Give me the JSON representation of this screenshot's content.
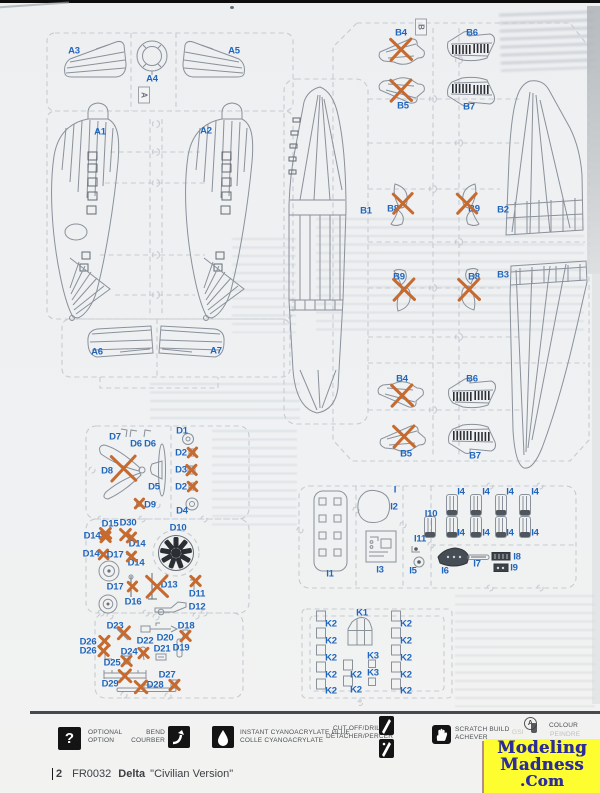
{
  "colors": {
    "label_blue": "#2166bd",
    "cross_orange": "#c66a2f",
    "watermark_bg": "#fdfd2f",
    "watermark_text": "#2d2d99",
    "paper": "#eff1f2"
  },
  "footer": {
    "page_number": "2",
    "kit_code": "FR0032",
    "kit_name": "Delta",
    "kit_variant": "\"Civilian Version\""
  },
  "watermark": {
    "line1": "Modeling",
    "line2": "Madness",
    "line3": ".Com"
  },
  "legend": {
    "optional": {
      "line1": "OPTIONAL",
      "line2": "OPTION"
    },
    "bend": {
      "line1": "BEND",
      "line2": "COURBER"
    },
    "glue": {
      "line1": "INSTANT CYANOACRYLATE GLUE",
      "line2": "COLLE CYANOACRYLATE"
    },
    "cut": {
      "line1": "CUT OFF/DRILL",
      "line2": "DÉTACHER/PERCER"
    },
    "scratch": {
      "line1": "SCRATCH BUILD",
      "line2": "ACHEVER"
    },
    "colour": {
      "badge": "A",
      "line1": "COLOUR",
      "line2": "PEINDRE",
      "note": "GSI"
    }
  },
  "sprues": [
    {
      "id": "A",
      "tag": {
        "text": "A",
        "x": 144,
        "y": 95
      },
      "parts": [
        {
          "label": "A3",
          "x": 74,
          "y": 51
        },
        {
          "label": "A4",
          "x": 152,
          "y": 79
        },
        {
          "label": "A5",
          "x": 234,
          "y": 51
        },
        {
          "label": "A1",
          "x": 100,
          "y": 132
        },
        {
          "label": "A2",
          "x": 206,
          "y": 131
        },
        {
          "label": "A6",
          "x": 97,
          "y": 352
        },
        {
          "label": "A7",
          "x": 216,
          "y": 351
        }
      ]
    },
    {
      "id": "B",
      "tag": {
        "text": "B",
        "x": 421,
        "y": 27
      },
      "parts": [
        {
          "label": "B4",
          "x": 401,
          "y": 33,
          "cross": {
            "x": 401,
            "y": 50,
            "s": 26
          }
        },
        {
          "label": "B6",
          "x": 472,
          "y": 33
        },
        {
          "label": "B5",
          "x": 403,
          "y": 106,
          "cross": {
            "x": 401,
            "y": 91,
            "s": 26
          }
        },
        {
          "label": "B7",
          "x": 469,
          "y": 107
        },
        {
          "label": "B1",
          "x": 366,
          "y": 211
        },
        {
          "label": "B8",
          "x": 393,
          "y": 209,
          "cross": {
            "x": 403,
            "y": 204,
            "s": 24
          }
        },
        {
          "label": "B9",
          "x": 474,
          "y": 209,
          "cross": {
            "x": 467,
            "y": 204,
            "s": 24
          }
        },
        {
          "label": "B2",
          "x": 503,
          "y": 210
        },
        {
          "label": "B9",
          "x": 399,
          "y": 277,
          "cross": {
            "x": 404,
            "y": 290,
            "s": 26
          }
        },
        {
          "label": "B8",
          "x": 474,
          "y": 277,
          "cross": {
            "x": 469,
            "y": 290,
            "s": 26
          }
        },
        {
          "label": "B3",
          "x": 503,
          "y": 275
        },
        {
          "label": "B4",
          "x": 402,
          "y": 379,
          "cross": {
            "x": 402,
            "y": 396,
            "s": 26
          }
        },
        {
          "label": "B6",
          "x": 472,
          "y": 379
        },
        {
          "label": "B5",
          "x": 406,
          "y": 454,
          "cross": {
            "x": 404,
            "y": 437,
            "s": 26
          }
        },
        {
          "label": "B7",
          "x": 475,
          "y": 456
        }
      ]
    },
    {
      "id": "D",
      "parts": [
        {
          "label": "D7",
          "x": 115,
          "y": 437
        },
        {
          "label": "D6",
          "x": 136,
          "y": 444
        },
        {
          "label": "D6",
          "x": 150,
          "y": 444
        },
        {
          "label": "D1",
          "x": 182,
          "y": 431
        },
        {
          "label": "D8",
          "x": 107,
          "y": 471,
          "cross": {
            "x": 124,
            "y": 469,
            "s": 30
          }
        },
        {
          "label": "D5",
          "x": 154,
          "y": 487
        },
        {
          "label": "D2",
          "x": 181,
          "y": 453,
          "cross": {
            "x": 192,
            "y": 453,
            "s": 12
          }
        },
        {
          "label": "D3",
          "x": 181,
          "y": 470,
          "cross": {
            "x": 192,
            "y": 470,
            "s": 13
          }
        },
        {
          "label": "D2",
          "x": 181,
          "y": 487,
          "cross": {
            "x": 192,
            "y": 487,
            "s": 12
          }
        },
        {
          "label": "D9",
          "x": 150,
          "y": 505,
          "cross": {
            "x": 139,
            "y": 504,
            "s": 12
          }
        },
        {
          "label": "D4",
          "x": 182,
          "y": 511
        },
        {
          "label": "D15",
          "x": 110,
          "y": 524,
          "cross": {
            "x": 106,
            "y": 534,
            "s": 14
          }
        },
        {
          "label": "D30",
          "x": 128,
          "y": 523,
          "cross": {
            "x": 126,
            "y": 535,
            "s": 14
          }
        },
        {
          "label": "D14",
          "x": 92,
          "y": 536,
          "cross": {
            "x": 106,
            "y": 537,
            "s": 13
          }
        },
        {
          "label": "D14",
          "x": 137,
          "y": 544,
          "cross": {
            "x": 131,
            "y": 538,
            "s": 12
          }
        },
        {
          "label": "D14",
          "x": 91,
          "y": 554,
          "cross": {
            "x": 103,
            "y": 555,
            "s": 12
          }
        },
        {
          "label": "D17",
          "x": 115,
          "y": 555
        },
        {
          "label": "D14",
          "x": 136,
          "y": 563,
          "cross": {
            "x": 131,
            "y": 557,
            "s": 12
          }
        },
        {
          "label": "D10",
          "x": 178,
          "y": 528
        },
        {
          "label": "D17",
          "x": 115,
          "y": 587,
          "cross": {
            "x": 132,
            "y": 587,
            "s": 12
          }
        },
        {
          "label": "D16",
          "x": 133,
          "y": 602
        },
        {
          "label": "D13",
          "x": 169,
          "y": 585,
          "cross": {
            "x": 157,
            "y": 587,
            "s": 26
          }
        },
        {
          "label": "D11",
          "x": 197,
          "y": 594,
          "cross": {
            "x": 196,
            "y": 581,
            "s": 13
          }
        },
        {
          "label": "D12",
          "x": 197,
          "y": 607
        },
        {
          "label": "D23",
          "x": 115,
          "y": 626,
          "cross": {
            "x": 124,
            "y": 633,
            "s": 15
          }
        },
        {
          "label": "D20",
          "x": 165,
          "y": 638
        },
        {
          "label": "D18",
          "x": 186,
          "y": 626,
          "cross": {
            "x": 186,
            "y": 636,
            "s": 13
          }
        },
        {
          "label": "D26",
          "x": 88,
          "y": 642,
          "cross": {
            "x": 105,
            "y": 641,
            "s": 13
          }
        },
        {
          "label": "D22",
          "x": 145,
          "y": 641,
          "cross": {
            "x": 144,
            "y": 653,
            "s": 13
          }
        },
        {
          "label": "D26",
          "x": 88,
          "y": 651,
          "cross": {
            "x": 104,
            "y": 651,
            "s": 13
          }
        },
        {
          "label": "D24",
          "x": 129,
          "y": 652,
          "cross": {
            "x": 127,
            "y": 661,
            "s": 13
          }
        },
        {
          "label": "D21",
          "x": 162,
          "y": 649
        },
        {
          "label": "D19",
          "x": 181,
          "y": 648
        },
        {
          "label": "D25",
          "x": 112,
          "y": 663
        },
        {
          "label": "D29",
          "x": 110,
          "y": 684,
          "cross": {
            "x": 125,
            "y": 676,
            "s": 15
          }
        },
        {
          "label": "D28",
          "x": 155,
          "y": 685,
          "cross": {
            "x": 141,
            "y": 687,
            "s": 15
          }
        },
        {
          "label": "D27",
          "x": 167,
          "y": 675,
          "cross": {
            "x": 175,
            "y": 685,
            "s": 13
          }
        }
      ]
    },
    {
      "id": "I",
      "parts": [
        {
          "label": "I",
          "x": 395,
          "y": 490
        },
        {
          "label": "I2",
          "x": 394,
          "y": 507
        },
        {
          "label": "I1",
          "x": 330,
          "y": 574
        },
        {
          "label": "I3",
          "x": 380,
          "y": 570
        },
        {
          "label": "I10",
          "x": 431,
          "y": 514
        },
        {
          "label": "I11",
          "x": 420,
          "y": 539
        },
        {
          "label": "I5",
          "x": 413,
          "y": 571
        },
        {
          "label": "I6",
          "x": 445,
          "y": 571
        },
        {
          "label": "I7",
          "x": 477,
          "y": 564
        },
        {
          "label": "I8",
          "x": 517,
          "y": 557
        },
        {
          "label": "I9",
          "x": 514,
          "y": 568
        },
        {
          "label": "I4",
          "x": 461,
          "y": 492
        },
        {
          "label": "I4",
          "x": 486,
          "y": 492
        },
        {
          "label": "I4",
          "x": 510,
          "y": 492
        },
        {
          "label": "I4",
          "x": 535,
          "y": 492
        },
        {
          "label": "I4",
          "x": 461,
          "y": 533
        },
        {
          "label": "I4",
          "x": 486,
          "y": 533
        },
        {
          "label": "I4",
          "x": 510,
          "y": 533
        },
        {
          "label": "I4",
          "x": 535,
          "y": 533
        }
      ]
    },
    {
      "id": "K",
      "parts": [
        {
          "label": "K1",
          "x": 362,
          "y": 613
        },
        {
          "label": "K2",
          "x": 331,
          "y": 624
        },
        {
          "label": "K2",
          "x": 331,
          "y": 641
        },
        {
          "label": "K2",
          "x": 331,
          "y": 658
        },
        {
          "label": "K2",
          "x": 331,
          "y": 675
        },
        {
          "label": "K2",
          "x": 331,
          "y": 691
        },
        {
          "label": "K2",
          "x": 406,
          "y": 624
        },
        {
          "label": "K2",
          "x": 406,
          "y": 641
        },
        {
          "label": "K2",
          "x": 406,
          "y": 658
        },
        {
          "label": "K2",
          "x": 406,
          "y": 675
        },
        {
          "label": "K2",
          "x": 406,
          "y": 691
        },
        {
          "label": "K2",
          "x": 356,
          "y": 675
        },
        {
          "label": "K2",
          "x": 356,
          "y": 690
        },
        {
          "label": "K3",
          "x": 373,
          "y": 656
        },
        {
          "label": "K3",
          "x": 373,
          "y": 673
        }
      ]
    }
  ]
}
